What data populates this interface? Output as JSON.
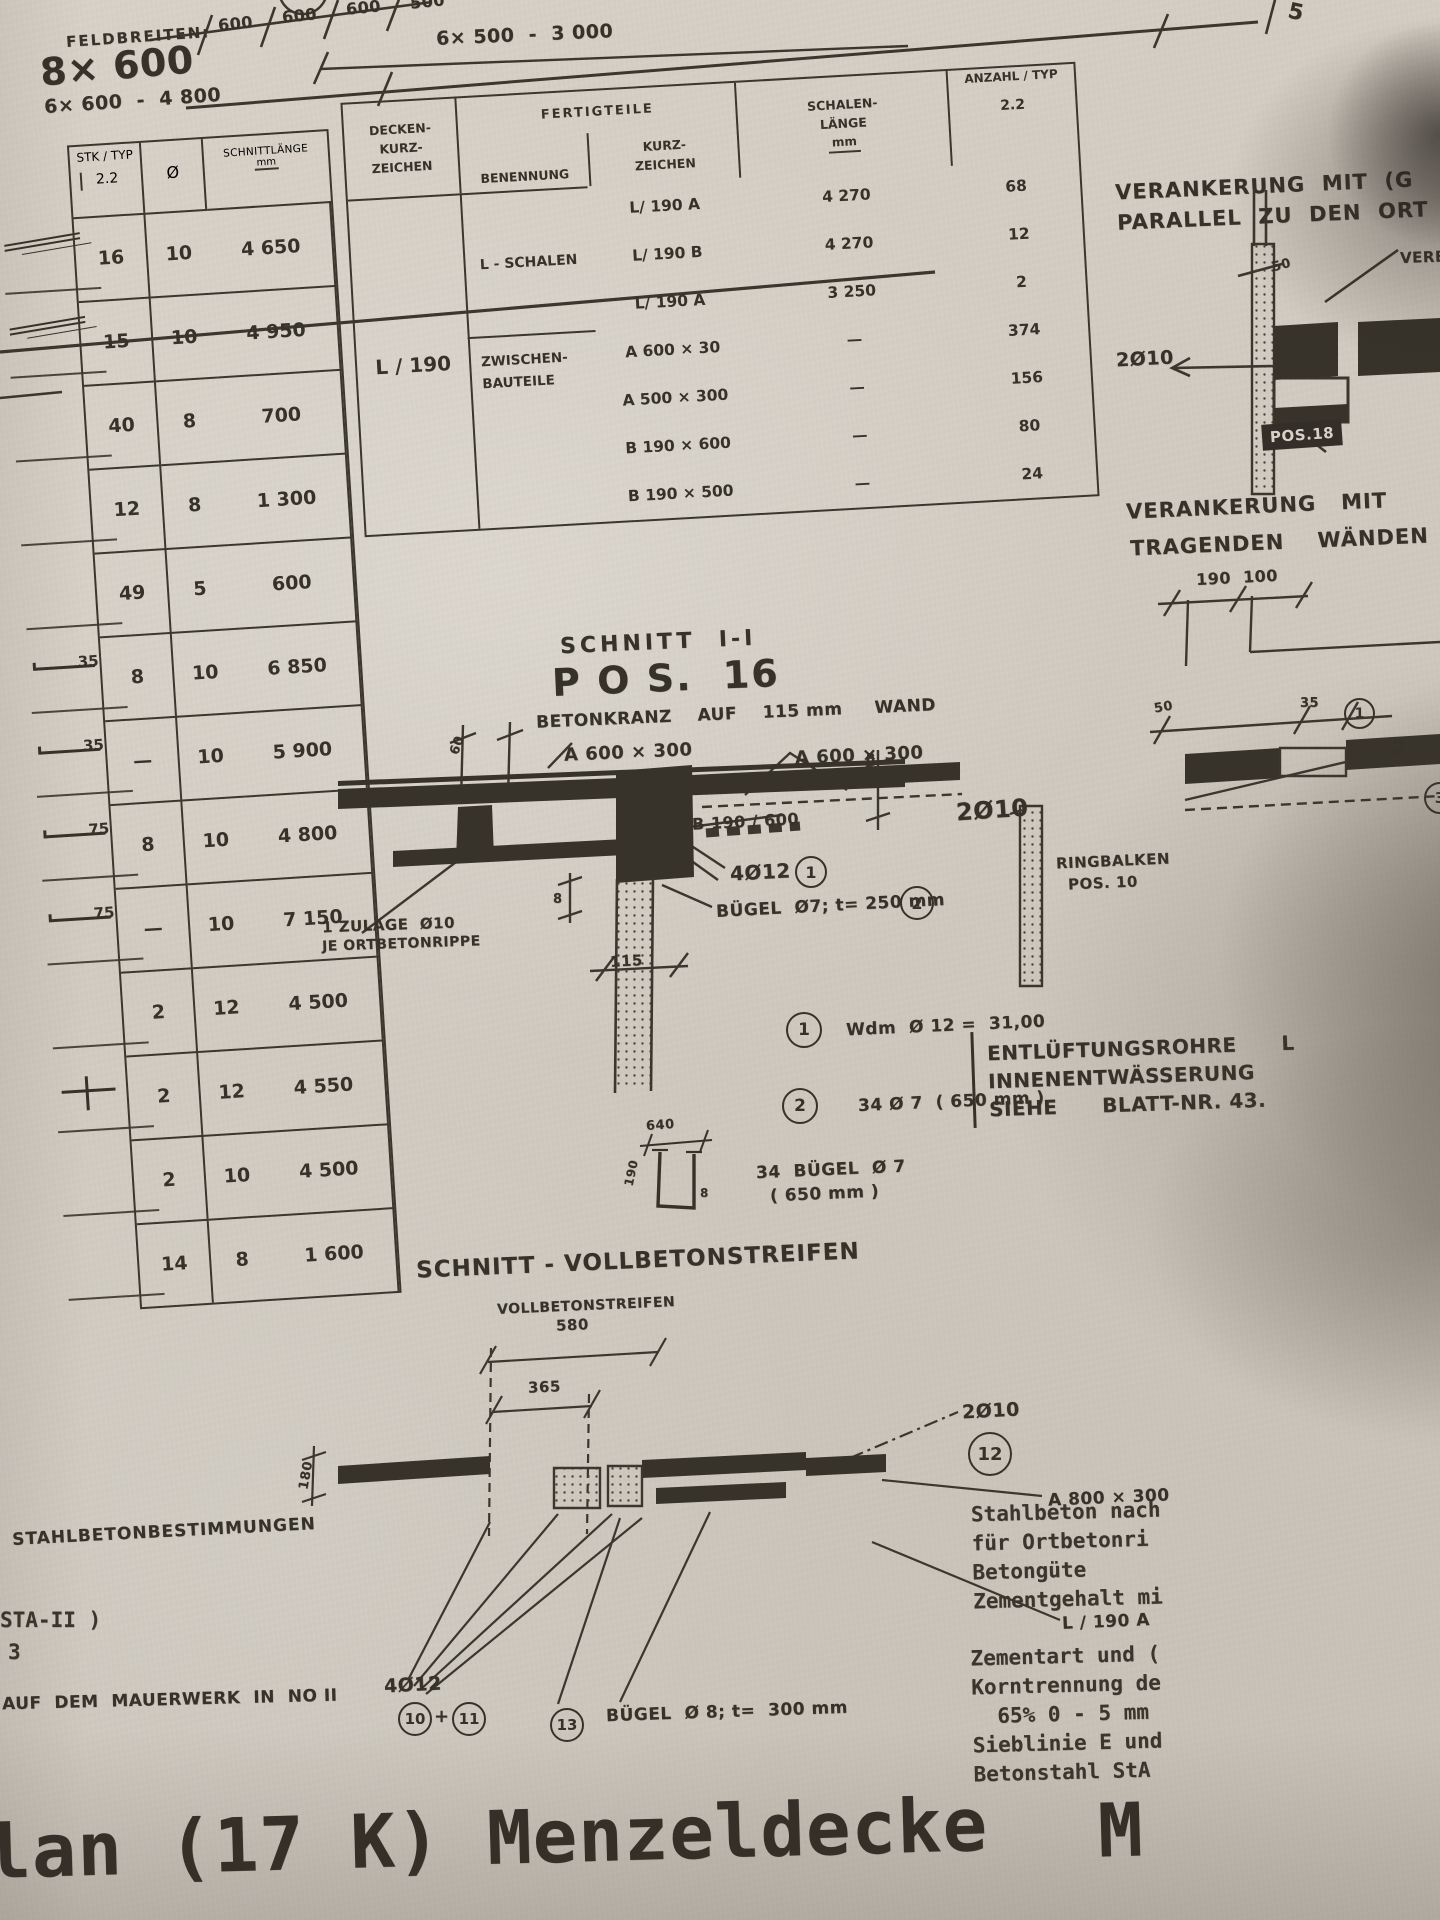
{
  "top": {
    "feldbreiten_label": "FELDBREITEN:",
    "feld_main": "8× 600",
    "feld_sub": "6× 600  -  4 800",
    "dims": [
      "600",
      "600",
      "600",
      "500"
    ],
    "total": "6× 500  -  3 000",
    "corner": "5"
  },
  "left_table": {
    "col_stk": "STK / TYP",
    "col_stk_sub": "2.2",
    "col_dia": "Ø",
    "col_len": "SCHNITTLÄNGE",
    "col_len_sub": "mm",
    "rows": [
      {
        "sk": "",
        "shape": "scribble",
        "stk": "16",
        "dia": "10",
        "len": "4 650"
      },
      {
        "sk": "",
        "shape": "scribble2",
        "stk": "15",
        "dia": "10",
        "len": "4 950"
      },
      {
        "sk": "",
        "shape": "",
        "stk": "40",
        "dia": "8",
        "len": "700"
      },
      {
        "sk": "",
        "shape": "",
        "stk": "12",
        "dia": "8",
        "len": "1 300"
      },
      {
        "sk": "",
        "shape": "",
        "stk": "49",
        "dia": "5",
        "len": "600"
      },
      {
        "sk": "35",
        "shape": "bar",
        "stk": "8",
        "dia": "10",
        "len": "6 850"
      },
      {
        "sk": "35",
        "shape": "bar",
        "stk": "—",
        "dia": "10",
        "len": "5 900"
      },
      {
        "sk": "75",
        "shape": "bar",
        "stk": "8",
        "dia": "10",
        "len": "4 800"
      },
      {
        "sk": "75",
        "shape": "bar",
        "stk": "—",
        "dia": "10",
        "len": "7 150"
      },
      {
        "sk": "",
        "shape": "",
        "stk": "2",
        "dia": "12",
        "len": "4 500"
      },
      {
        "sk": "",
        "shape": "tbar",
        "stk": "2",
        "dia": "12",
        "len": "4 550"
      },
      {
        "sk": "",
        "shape": "",
        "stk": "2",
        "dia": "10",
        "len": "4 500"
      },
      {
        "sk": "",
        "shape": "",
        "stk": "14",
        "dia": "8",
        "len": "1 600"
      }
    ]
  },
  "mid_table": {
    "h_decken_1": "DECKEN-",
    "h_decken_2": "KURZ-",
    "h_decken_3": "ZEICHEN",
    "h_fertig": "FERTIGTEILE",
    "h_benennung": "BENENNUNG",
    "h_kurz_1": "KURZ-",
    "h_kurz_2": "ZEICHEN",
    "h_len_1": "SCHALEN-",
    "h_len_2": "LÄNGE",
    "h_len_3": "mm",
    "h_anzahl": "ANZAHL / TYP",
    "h_anzahl_sub": "2.2",
    "decken_value": "L / 190",
    "group1": "L - SCHALEN",
    "group2_1": "ZWISCHEN-",
    "group2_2": "BAUTEILE",
    "rows": [
      {
        "kurz": "L/ 190  A",
        "len": "4 270",
        "anz": "68"
      },
      {
        "kurz": "L/ 190  B",
        "len": "4 270",
        "anz": "12"
      },
      {
        "kurz": "L/ 190  A",
        "len": "3 250",
        "anz": "2"
      },
      {
        "kurz": "A 600 × 30",
        "len": "—",
        "anz": "374"
      },
      {
        "kurz": "A 500 × 300",
        "len": "—",
        "anz": "156"
      },
      {
        "kurz": "B 190 × 600",
        "len": "—",
        "anz": "80"
      },
      {
        "kurz": "B 190 × 500",
        "len": "—",
        "anz": "24"
      }
    ]
  },
  "s1": {
    "title": "SCHNITT  I-I",
    "pos": "P O S.  16",
    "sub": "BETONKRANZ    AUF    115 mm     WAND",
    "a_left": "A 600 × 300",
    "a_right": "A 600 × 300",
    "b": "B 190 / 600",
    "d60": "60",
    "d8a": "8",
    "d8b": "8",
    "d115": "115",
    "r4": "4Ø12",
    "c1": "1",
    "bg": "BÜGEL  Ø7; t= 250 mm",
    "c2": "2",
    "z1": "1 ZULAGE  Ø10",
    "z2": "JE ORTBETONRIPPE"
  },
  "notes": {
    "c1": "1",
    "t1": "Wdm  Ø 12 =  31,00",
    "c2": "2",
    "t2": "34 Ø 7  ( 650 mm )"
  },
  "stirrup": {
    "d_top": "640",
    "d_left": "190",
    "d_right": "8",
    "l1": "34  BÜGEL  Ø 7",
    "l2": "( 650 mm )"
  },
  "s2": {
    "title": "SCHNITT - VOLLBETONSTREIFEN",
    "sub": "VOLLBETONSTREIFEN",
    "d580": "580",
    "d365": "365",
    "d180": "180",
    "l2d10": "2Ø10",
    "c12": "12",
    "a800": "A 800 × 300",
    "l190": "L / 190 A",
    "l4d12": "4Ø12",
    "c10": "10",
    "plus": "+",
    "c11": "11",
    "c13": "13",
    "bg": "BÜGEL  Ø 8; t=  300 mm"
  },
  "right": {
    "v1a": "VERANKERUNG  MIT  (G",
    "v1b": "PARALLEL  ZU  DEN  ORT",
    "verbr": "VERBR",
    "d50a": "50",
    "l2d10a": "2Ø10",
    "pos18": "POS.18",
    "v2a": "VERANKERUNG   MIT",
    "v2b": "TRAGENDEN    WÄNDEN",
    "d190": "190  100",
    "d50b": "50",
    "d35": "35",
    "c1": "1",
    "n2": "2",
    "l2d10b": "2Ø10",
    "rb1": "RINGBALKEN",
    "rb2": "POS. 10",
    "c3": "3",
    "ent": [
      "ENTLÜFTUNGSROHRE      L",
      "INNENENTWÄSSERUNG",
      "SIEHE      BLATT-NR. 43."
    ],
    "spec1": [
      "Stahlbeton nach",
      "für Ortbetonri",
      "Betongüte",
      "Zementgehalt mi"
    ],
    "spec2": [
      "Zementart und (",
      "Korntrennung de",
      "  65% 0 - 5 mm",
      "Sieblinie E und",
      "Betonstahl StA"
    ]
  },
  "bottom": {
    "stb": "STAHLBETONBESTIMMUNGEN",
    "sta": "STA-II )",
    "e3": "3",
    "mauer": "AUF  DEM  MAUERWERK  IN  NO II",
    "big": "lan (17 K) Menzeldecke",
    "m": "M"
  }
}
